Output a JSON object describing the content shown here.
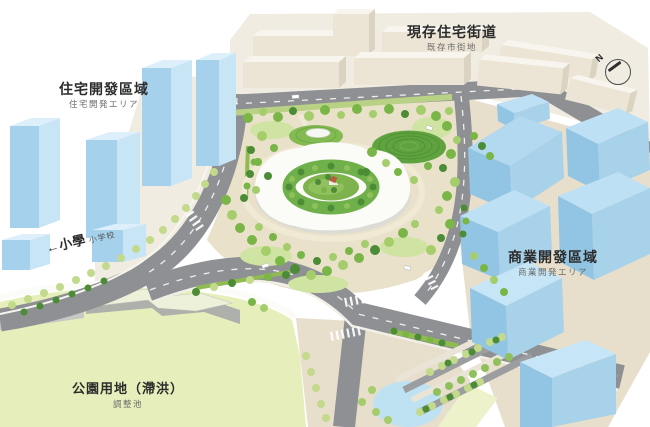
{
  "annotations": {
    "existing_residential": {
      "title": "現存住宅街道",
      "subtitle": "既存市街地"
    },
    "residential_development": {
      "title": "住宅開發區域",
      "subtitle": "住宅開発エリア"
    },
    "elementary_school": {
      "arrow_title": "←小學",
      "subtitle": "小学校"
    },
    "commercial_development": {
      "title": "商業開發區域",
      "subtitle": "商業開発エリア"
    },
    "park_detention": {
      "title": "公園用地（滯洪）",
      "subtitle": "調整池"
    },
    "compass": {
      "north_label": "N"
    }
  },
  "colors": {
    "development_block_blue": "#a6d1ec",
    "existing_block_cream": "#ece5d6",
    "road_gray": "#8e9093",
    "park_ground_tan": "#e9e1ca",
    "field_green": "#e6efbb",
    "tree_green": "#79b647",
    "label_text": "#2b2b2b"
  }
}
